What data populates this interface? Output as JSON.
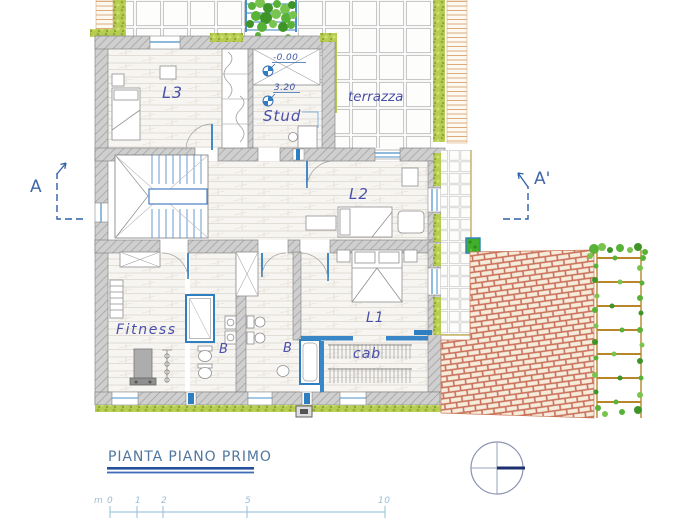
{
  "plan": {
    "rooms": {
      "l3": "L3",
      "stud": "Stud",
      "terrazza": "terrazza",
      "l2": "L2",
      "l1": "L1",
      "fitness": "Fitness",
      "bath_a": "B",
      "bath_b": "B",
      "cab": "cab"
    },
    "levels": {
      "entrance": "-0.00",
      "first_floor": "3.20"
    },
    "section": {
      "left": "A",
      "right": "A'"
    }
  },
  "title_block": {
    "title": "PIANTA PIANO PRIMO"
  },
  "scale_bar": {
    "unit": "m",
    "ticks": [
      "0",
      "1",
      "2",
      "5",
      "10"
    ]
  },
  "colors": {
    "wall_fill": "#cfcfcf",
    "wall_hatch": "#9b9b9b",
    "accent_blue": "#2e7fc2",
    "label_blue": "#4a4fa8",
    "hedge_green": "#b7cd52",
    "plant_green": "#58b237",
    "brick_red": "#c4604a",
    "paving_tan": "#dcab7c",
    "title_blue": "#51779e",
    "underline_navy": "#24509b",
    "scale_blue": "#9cbcd4"
  }
}
